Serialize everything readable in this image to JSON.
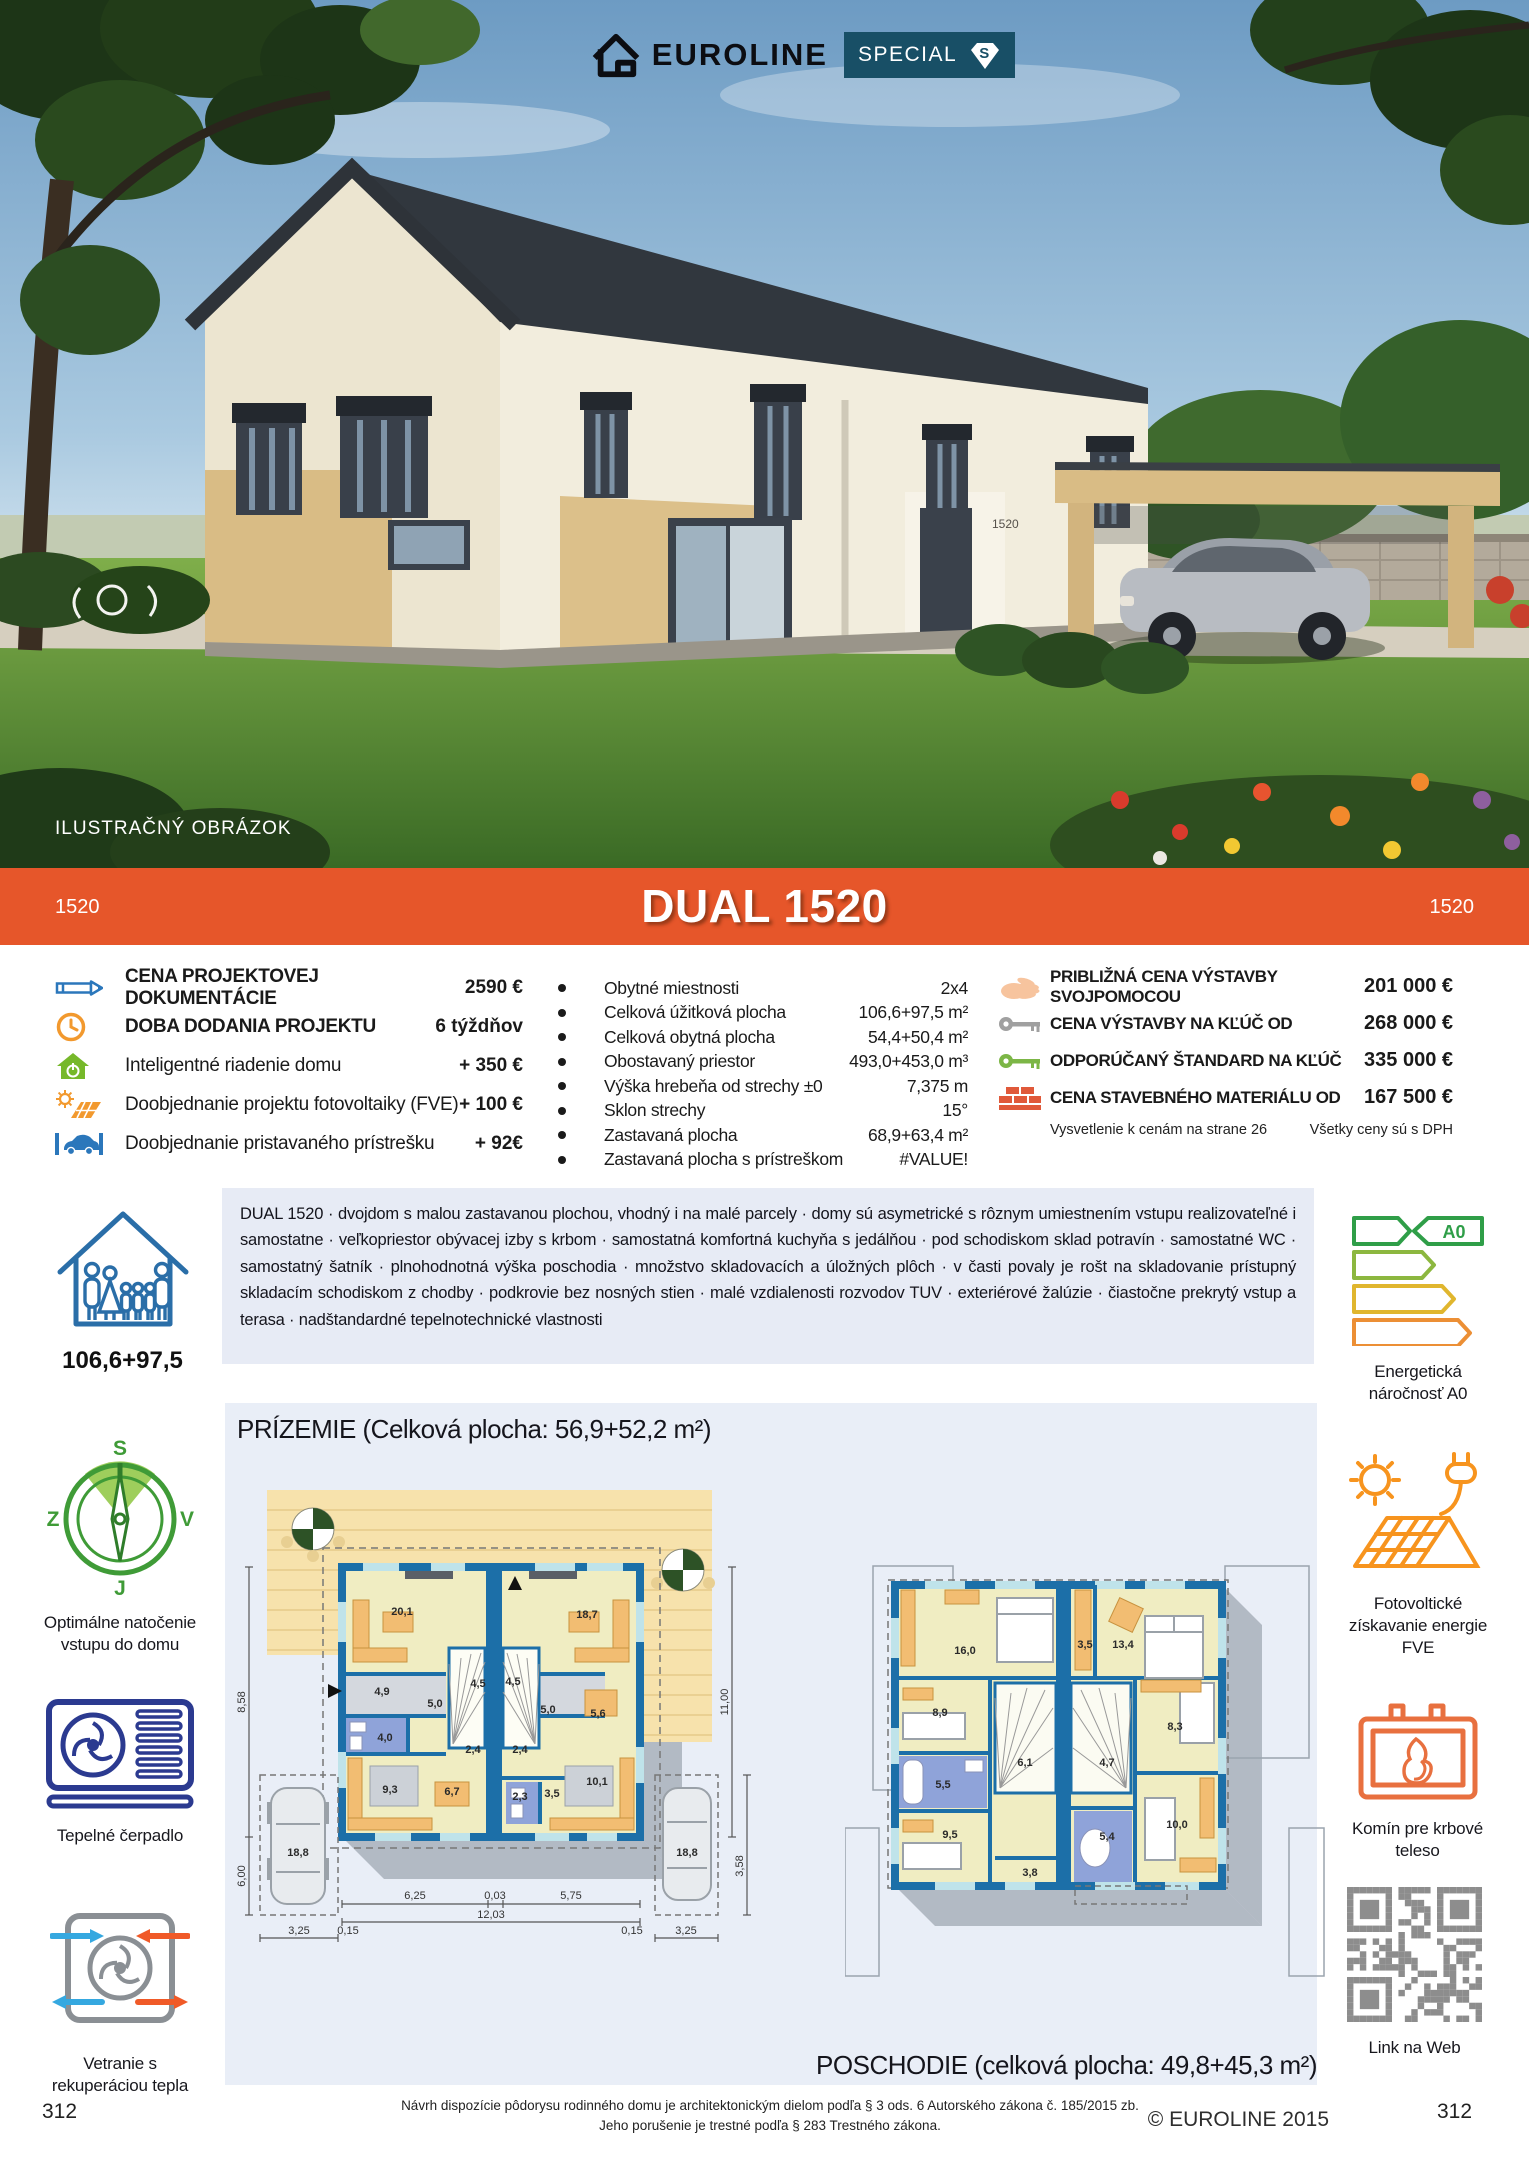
{
  "colors": {
    "accent_orange": "#e6562a",
    "badge_teal": "#184f66",
    "panel_blue": "#e7ebf5",
    "plan_wall_blue": "#1c6fa8"
  },
  "header": {
    "brand": "EUROLINE",
    "badge": "SPECIAL",
    "badge_letter": "S",
    "photo_caption": "ILUSTRAČNÝ OBRÁZOK",
    "house_number": "1520"
  },
  "banner": {
    "code_left": "1520",
    "title": "DUAL 1520",
    "code_right": "1520"
  },
  "pricing_left": {
    "rows": [
      {
        "icon": "pencil-icon",
        "label": "CENA PROJEKTOVEJ DOKUMENTÁCIE",
        "value": "2590 €"
      },
      {
        "icon": "clock-icon",
        "label": "DOBA DODANIA PROJEKTU",
        "value": "6 týždňov"
      },
      {
        "icon": "smart-home-icon",
        "label": "Inteligentné riadenie domu",
        "value": "+ 350 €"
      },
      {
        "icon": "solar-project-icon",
        "label": "Doobjednanie projektu fotovoltaiky (FVE)",
        "value": "+ 100 €"
      },
      {
        "icon": "carport-icon",
        "label": "Doobjednanie pristavaného prístrešku",
        "value": "+ 92€"
      }
    ]
  },
  "specs": {
    "rows": [
      {
        "label": "Obytné miestnosti",
        "value": "2x4"
      },
      {
        "label": "Celková úžitková plocha",
        "value": "106,6+97,5 m²"
      },
      {
        "label": "Celková obytná plocha",
        "value": "54,4+50,4 m²"
      },
      {
        "label": "Obostavaný priestor",
        "value": "493,0+453,0 m³"
      },
      {
        "label": "Výška hrebeňa od strechy ±0",
        "value": "7,375 m"
      },
      {
        "label": "Sklon strechy",
        "value": "15°"
      },
      {
        "label": "Zastavaná plocha",
        "value": "68,9+63,4 m²"
      },
      {
        "label": "Zastavaná plocha s prístreškom",
        "value": "#VALUE!"
      }
    ]
  },
  "pricing_right": {
    "rows": [
      {
        "icon": "hand-icon",
        "label": "PRIBLIŽNÁ CENA VÝSTAVBY SVOJPOMOCOU",
        "value": "201 000 €"
      },
      {
        "icon": "key-gray-icon",
        "label": "CENA VÝSTAVBY NA KĽÚČ OD",
        "value": "268 000 €"
      },
      {
        "icon": "key-green-icon",
        "label": "ODPORÚČANÝ ŠTANDARD NA KĽÚČ",
        "value": "335 000 €"
      },
      {
        "icon": "bricks-icon",
        "label": "CENA STAVEBNÉHO MATERIÁLU OD",
        "value": "167 500 €"
      }
    ],
    "note_left": "Vysvetlenie k cenám na strane 26",
    "note_right": "Všetky ceny sú s DPH"
  },
  "description": {
    "text": "DUAL 1520 · dvojdom s malou zastavanou plochou, vhodný i na malé parcely · domy sú asymetrické s rôznym umiestnením vstupu realizovateľné i samostatne · veľkopriestor obývacej izby s krbom · samostatná komfortná kuchyňa s jedálňou · pod schodiskom sklad potravín · samostatné WC · samostatný šatník · plnohodnotná výška poschodia · množstvo skladovacích a úložných plôch · v časti povaly je rošt na skladovanie prístupný skladacím schodiskom z chodby · podkrovie bez nosných stien · malé vzdialenosti rozvodov TUV · exteriérové žalúzie · čiastočne prekrytý vstup a terasa · nadštandardné tepelnotechnické vlastnosti"
  },
  "sidebar_left": {
    "area_label": "106,6+97,5",
    "compass": {
      "n": "S",
      "e": "V",
      "s": "J",
      "w": "Z"
    },
    "compass_label": "Optimálne natočenie vstupu do domu",
    "heat_pump_label": "Tepelné čerpadlo",
    "ventilation_label": "Vetranie s rekuperáciou tepla"
  },
  "sidebar_right": {
    "energy_badge": "A0",
    "energy_label": "Energetická náročnosť A0",
    "pv_label": "Fotovoltické získavanie energie FVE",
    "chimney_label": "Komín pre krbové teleso",
    "qr_label": "Link na Web"
  },
  "plans": {
    "prizemie": {
      "title": "PRÍZEMIE (Celková plocha: 56,9+52,2 m²)",
      "rooms": [
        "20,1",
        "4,9",
        "5,0",
        "4,5",
        "4,0",
        "9,3",
        "6,7",
        "2,4",
        "18,7",
        "4,5",
        "5,0",
        "5,6",
        "2,4",
        "2,3",
        "3,5",
        "10,1"
      ],
      "parking_left": "18,8",
      "parking_right": "18,8",
      "dims": [
        "8,58",
        "6,00",
        "11,00",
        "3,58",
        "6,25",
        "0,03",
        "5,75",
        "12,03",
        "0,15",
        "0,15",
        "3,25",
        "3,25"
      ]
    },
    "poschodie": {
      "title": "POSCHODIE (celková plocha: 49,8+45,3 m²)",
      "rooms": [
        "16,0",
        "8,9",
        "5,5",
        "6,1",
        "9,5",
        "3,8",
        "3,5",
        "13,4",
        "8,3",
        "4,7",
        "5,4",
        "10,0"
      ]
    }
  },
  "footer": {
    "page_left": "312",
    "page_right": "312",
    "legal_line1": "Návrh dispozície pôdorysu rodinného domu je architektonickým dielom podľa § 3 ods. 6 Autorského zákona č. 185/2015 zb.",
    "legal_line2": "Jeho porušenie je trestné podľa § 283 Trestného zákona.",
    "copyright": "© EUROLINE 2015"
  }
}
